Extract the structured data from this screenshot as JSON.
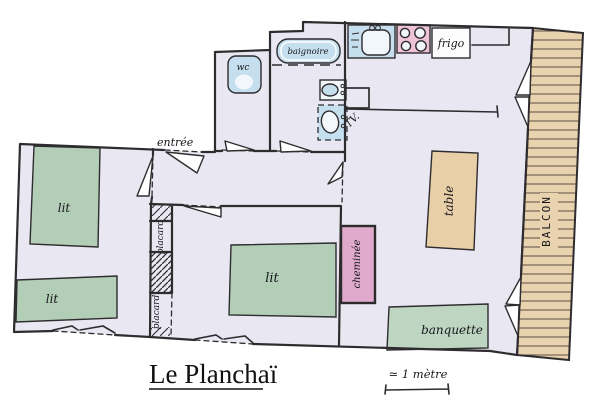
{
  "title": "Le Planchaï",
  "scale": {
    "label": "≃ 1 mètre"
  },
  "labels": {
    "entree": "entrée",
    "wc": "wc",
    "baignoire": "baignoire",
    "frigo": "frigo",
    "tv": "TV.",
    "bed1": "lit",
    "bed2": "lit",
    "bed3": "lit",
    "placard1": "placard",
    "placard2": "placard",
    "cheminee": "cheminée",
    "table": "table",
    "banquette": "banquette",
    "balcon": "BALCON"
  },
  "colors": {
    "paper": "#ffffff",
    "floor": "#e9e8f2",
    "wall": "#2e2c2e",
    "bed_green": "#b3ceb7",
    "banquette_green": "#bdd5c1",
    "table_tan": "#e8cfa8",
    "balcony_tan": "#e9d2ae",
    "fireplace_pink": "#dfaacb",
    "stove_pink": "#eec3d6",
    "fixture_blue": "#c6dfef",
    "basin_white": "#f2f7fc"
  }
}
